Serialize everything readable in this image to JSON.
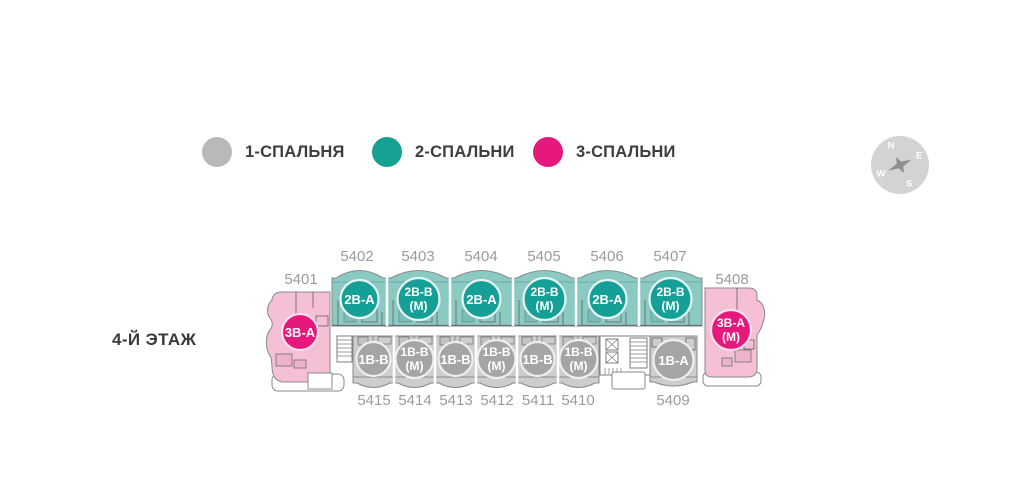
{
  "legend": {
    "items": [
      {
        "label": "1-СПАЛЬНЯ",
        "color": "#b9b9b9"
      },
      {
        "label": "2-СПАЛЬНИ",
        "color": "#17a193"
      },
      {
        "label": "3-СПАЛЬНИ",
        "color": "#e6177d"
      }
    ]
  },
  "floor": {
    "label": "4-Й ЭТАЖ"
  },
  "compass": {
    "north": "N",
    "east": "E",
    "south": "S",
    "west": "W"
  },
  "colors": {
    "band_teal": "#8bcac3",
    "badge_teal": "#14a096",
    "band_gray": "#cdcdcd",
    "badge_gray": "#a5a5a5",
    "band_pink": "#f5c0d5",
    "badge_pink": "#e6187c",
    "outline": "#8a8a8a",
    "number_text": "#9b9b9b"
  },
  "plan": {
    "left_unit": {
      "number": "5401",
      "type": "3В-А"
    },
    "right_unit": {
      "number": "5408",
      "type": "3В-А",
      "type_suffix": "(М)"
    },
    "top_row": [
      {
        "number": "5402",
        "type": "2В-А"
      },
      {
        "number": "5403",
        "type": "2В-В",
        "type_suffix": "(М)"
      },
      {
        "number": "5404",
        "type": "2В-А"
      },
      {
        "number": "5405",
        "type": "2В-В",
        "type_suffix": "(М)"
      },
      {
        "number": "5406",
        "type": "2В-А"
      },
      {
        "number": "5407",
        "type": "2В-В",
        "type_suffix": "(М)"
      }
    ],
    "bottom_row": [
      {
        "number": "5415",
        "type": "1В-В"
      },
      {
        "number": "5414",
        "type": "1В-В",
        "type_suffix": "(М)"
      },
      {
        "number": "5413",
        "type": "1В-В"
      },
      {
        "number": "5412",
        "type": "1В-В",
        "type_suffix": "(М)"
      },
      {
        "number": "5411",
        "type": "1В-В"
      },
      {
        "number": "5410",
        "type": "1В-В",
        "type_suffix": "(М)"
      },
      {
        "number": "5409",
        "type": "1В-А"
      }
    ]
  }
}
